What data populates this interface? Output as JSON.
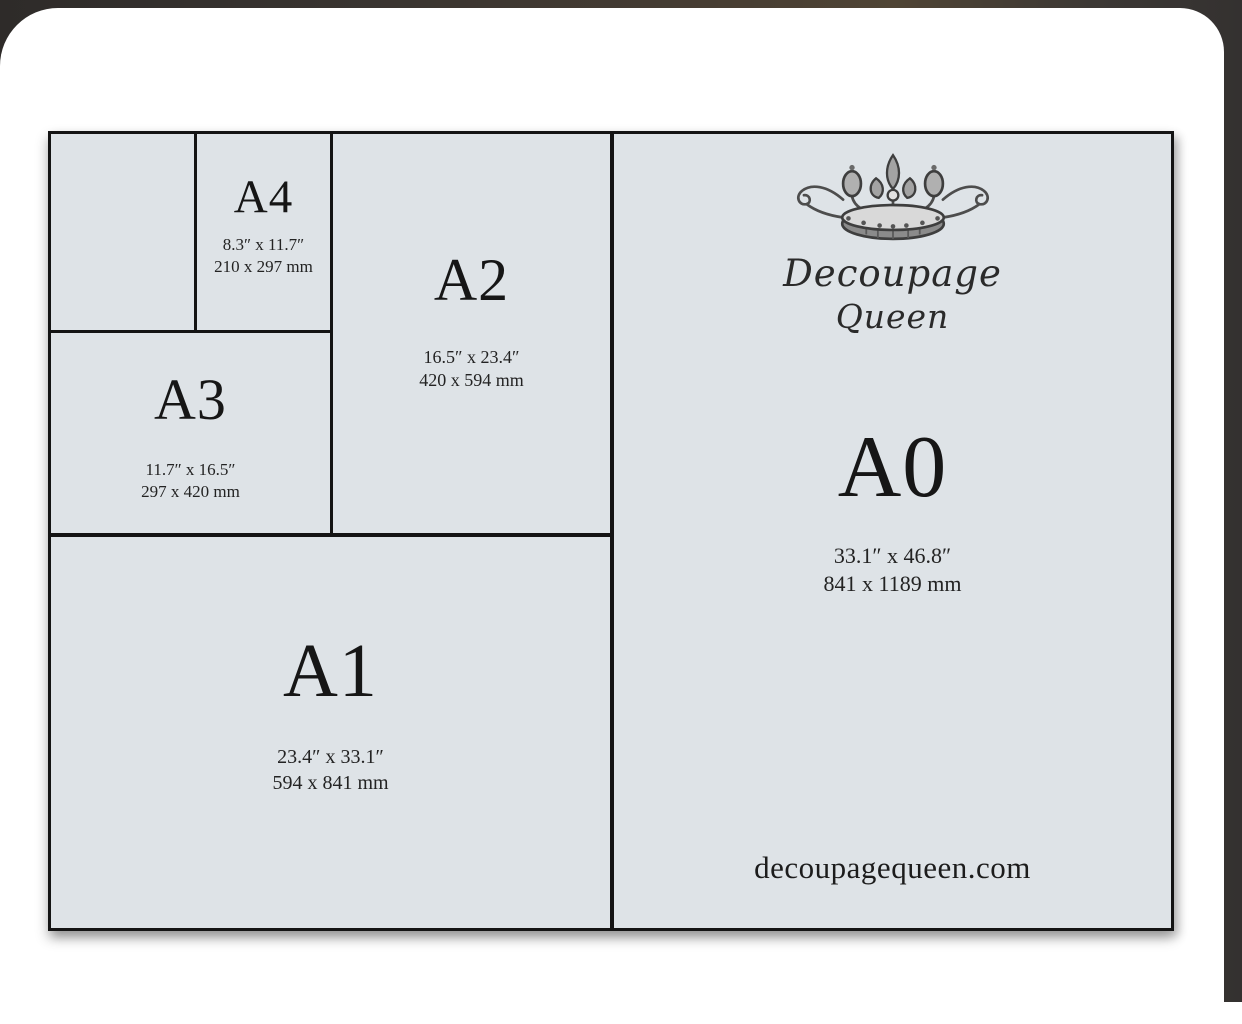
{
  "card": {
    "website": "decoupagequeen.com",
    "brand": {
      "name_line1": "Decoupage",
      "name_line2": "Queen"
    }
  },
  "sizes": {
    "a4": {
      "label": "A4",
      "inches": "8.3″ x 11.7″",
      "mm": "210 x 297 mm"
    },
    "a3": {
      "label": "A3",
      "inches": "11.7″ x 16.5″",
      "mm": "297 x 420 mm"
    },
    "a2": {
      "label": "A2",
      "inches": "16.5″ x 23.4″",
      "mm": "420 x 594 mm"
    },
    "a1": {
      "label": "A1",
      "inches": "23.4″ x 33.1″",
      "mm": "594 x 841 mm"
    },
    "a0": {
      "label": "A0",
      "inches": "33.1″ x 46.8″",
      "mm": "841 x 1189 mm"
    }
  },
  "icons": {
    "crown": "crown-icon"
  },
  "colors": {
    "paper_background": "#dee3e7",
    "frame_line": "#141414",
    "text": "#1b1b1b",
    "card_background": "#ffffff",
    "backdrop_dark": "#2e2b29",
    "backdrop_brown": "#7b5d33"
  }
}
